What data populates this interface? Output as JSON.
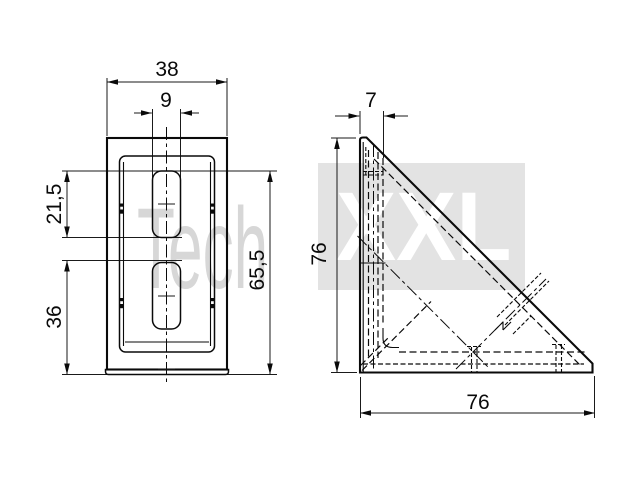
{
  "page": {
    "background": "#ffffff",
    "line_color": "#0a0a0a",
    "description_texts_visible": "technical drawing, two orthographic views of an angle bracket"
  },
  "watermark": {
    "left": "Tech",
    "right": "XXL",
    "band_color": "#e3e3e3",
    "left_text_color": "#d7d7d7",
    "right_text_color": "#ffffff"
  },
  "dimensions": {
    "front_width": "38",
    "front_slot_width": "9",
    "front_slot_length": "21,5",
    "front_slot2_to_bottom": "36",
    "front_slot1_to_bottom": "65,5",
    "side_leg_thickness": "7",
    "side_height": "76",
    "side_depth": "76"
  }
}
